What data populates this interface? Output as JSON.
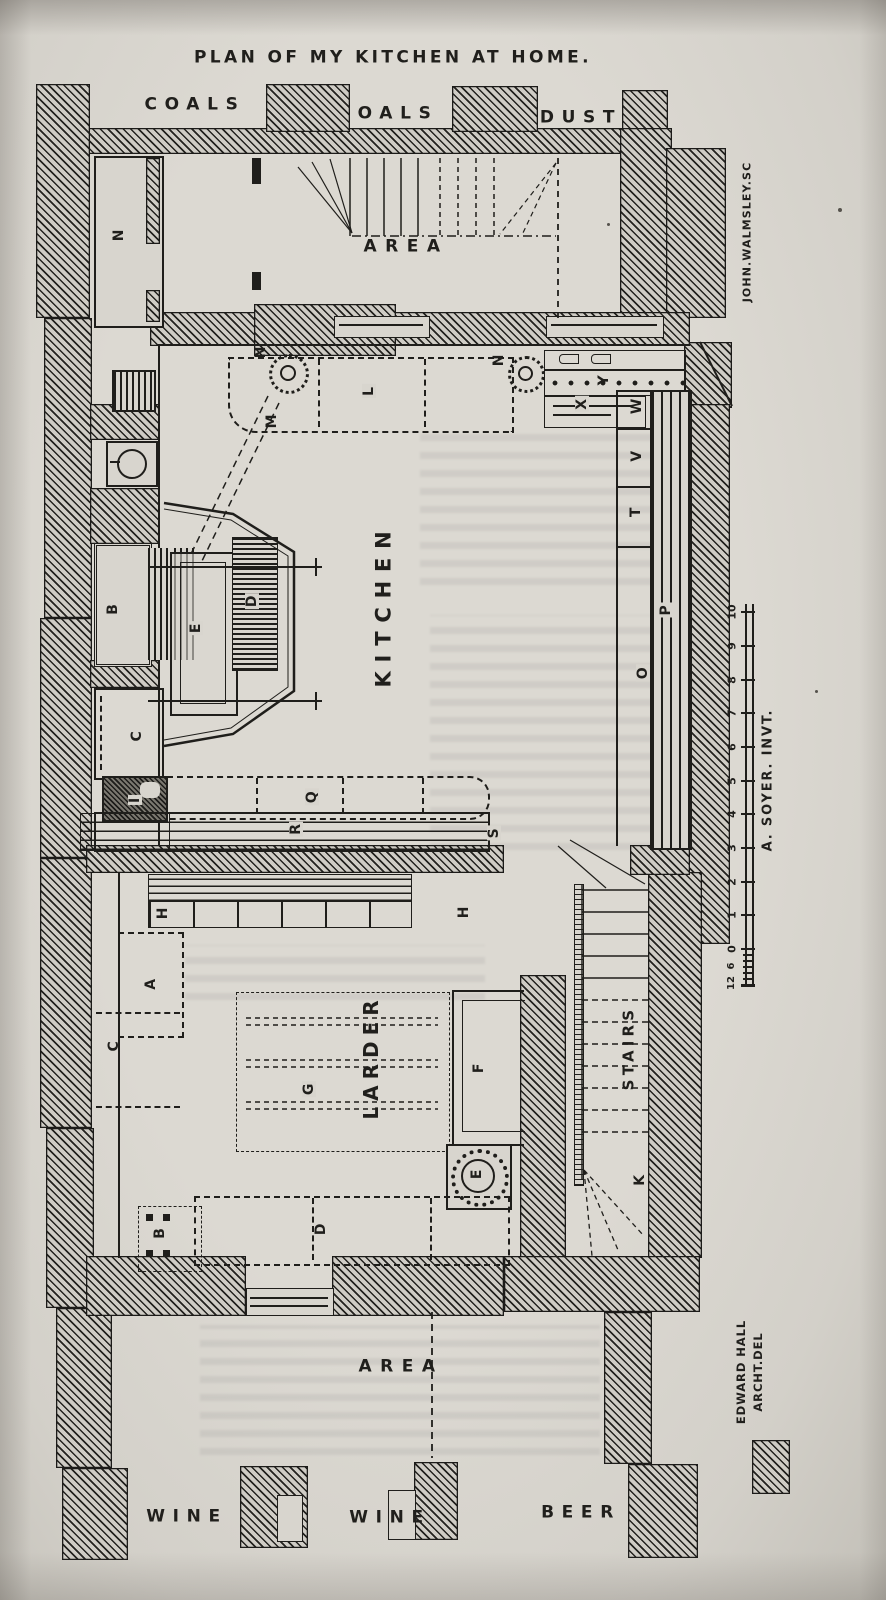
{
  "page": {
    "title": "PLAN OF MY KITCHEN AT HOME."
  },
  "rooms": {
    "coals_left": "COALS",
    "coals_center": "COALS",
    "dust": "DUST",
    "area_top": "AREA",
    "kitchen": "KITCHEN",
    "larder": "LARDER",
    "stairs": "STAIRS",
    "area_bottom": "AREA",
    "wine_left": "WINE",
    "wine_center": "WINE",
    "beer": "BEER"
  },
  "markers": {
    "n_room": "N",
    "n_tap_left": "N",
    "m_corner": "M",
    "l_dresser": "L",
    "n_tap_right": "N",
    "y_strip": "Y",
    "x_strip": "X",
    "w_box": "W",
    "v_box": "V",
    "t_box": "T",
    "p_range": "P",
    "o_range": "O",
    "b_range": "B",
    "e_screen": "E",
    "d_screen": "D",
    "c_closet": "C",
    "i_sink": "I",
    "h_shelf_left": "H",
    "h_shelf_right": "H",
    "q_table": "Q",
    "r_rack": "R",
    "s_end": "S",
    "a_lobby": "A",
    "c_cellar": "C",
    "g_rails": "G",
    "f_bench": "F",
    "e_basin": "E",
    "d_room": "D",
    "b_room": "B",
    "k_stairs": "K"
  },
  "credits": {
    "engraver": "JOHN.WALMSLEY.SC",
    "inventor": "A. SOYER. INVT.",
    "architect_line1": "EDWARD HALL",
    "architect_line2": "ARCHT.DEL"
  },
  "scale": {
    "feet": [
      "10",
      "9",
      "8",
      "7",
      "6",
      "5",
      "4",
      "3",
      "2",
      "1",
      "0"
    ],
    "inches": [
      "6",
      "12"
    ]
  }
}
